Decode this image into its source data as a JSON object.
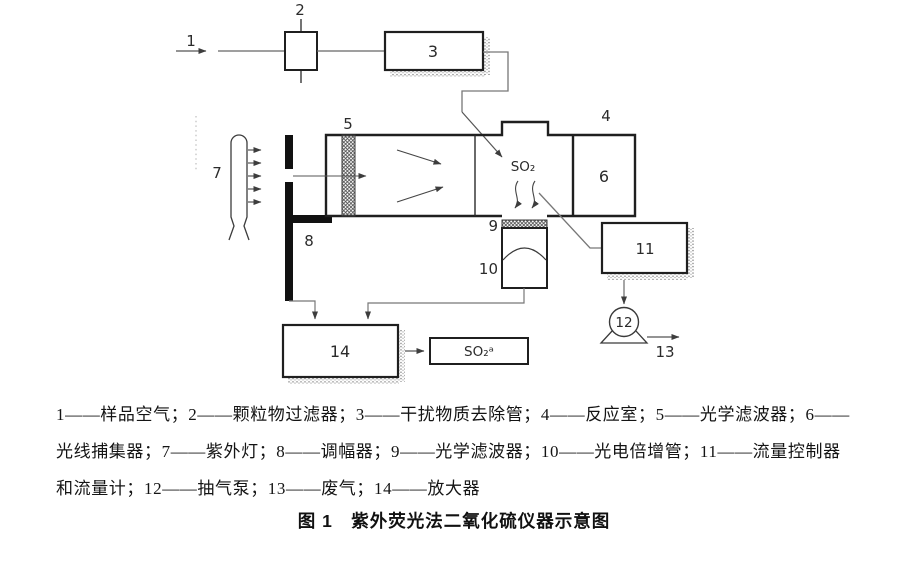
{
  "figure": {
    "caption": "图 1　紫外荧光法二氧化硫仪器示意图"
  },
  "diagram": {
    "node_labels": {
      "n1": "1",
      "n2": "2",
      "n3": "3",
      "n4": "4",
      "n5": "5",
      "n6": "6",
      "n7": "7",
      "n8": "8",
      "n9": "9",
      "n10": "10",
      "n11": "11",
      "n12": "12",
      "n13": "13",
      "n14": "14"
    },
    "annotations": {
      "so2_chamber": "SO₂",
      "so2_output": "SO₂ᵃ"
    }
  },
  "legend": {
    "line1": "1——样品空气；2——颗粒物过滤器；3——干扰物质去除管；4——反应室；5——光学滤波器；6——",
    "line2": "光线捕集器；7——紫外灯；8——调幅器；9——光学滤波器；10——光电倍增管；11——流量控制器",
    "line3": "和流量计；12——抽气泵；13——废气；14——放大器",
    "components": [
      {
        "num": "1",
        "name": "样品空气"
      },
      {
        "num": "2",
        "name": "颗粒物过滤器"
      },
      {
        "num": "3",
        "name": "干扰物质去除管"
      },
      {
        "num": "4",
        "name": "反应室"
      },
      {
        "num": "5",
        "name": "光学滤波器"
      },
      {
        "num": "6",
        "name": "光线捕集器"
      },
      {
        "num": "7",
        "name": "紫外灯"
      },
      {
        "num": "8",
        "name": "调幅器"
      },
      {
        "num": "9",
        "name": "光学滤波器"
      },
      {
        "num": "10",
        "name": "光电倍增管"
      },
      {
        "num": "11",
        "name": "流量控制器和流量计"
      },
      {
        "num": "12",
        "name": "抽气泵"
      },
      {
        "num": "13",
        "name": "废气"
      },
      {
        "num": "14",
        "name": "放大器"
      }
    ]
  },
  "colors": {
    "background": "#ffffff",
    "thin_line": "#6a6a6a",
    "border": "#1f1f1f",
    "text": "#1a1a1a",
    "shadow_stipple": "#8f8f8f"
  }
}
